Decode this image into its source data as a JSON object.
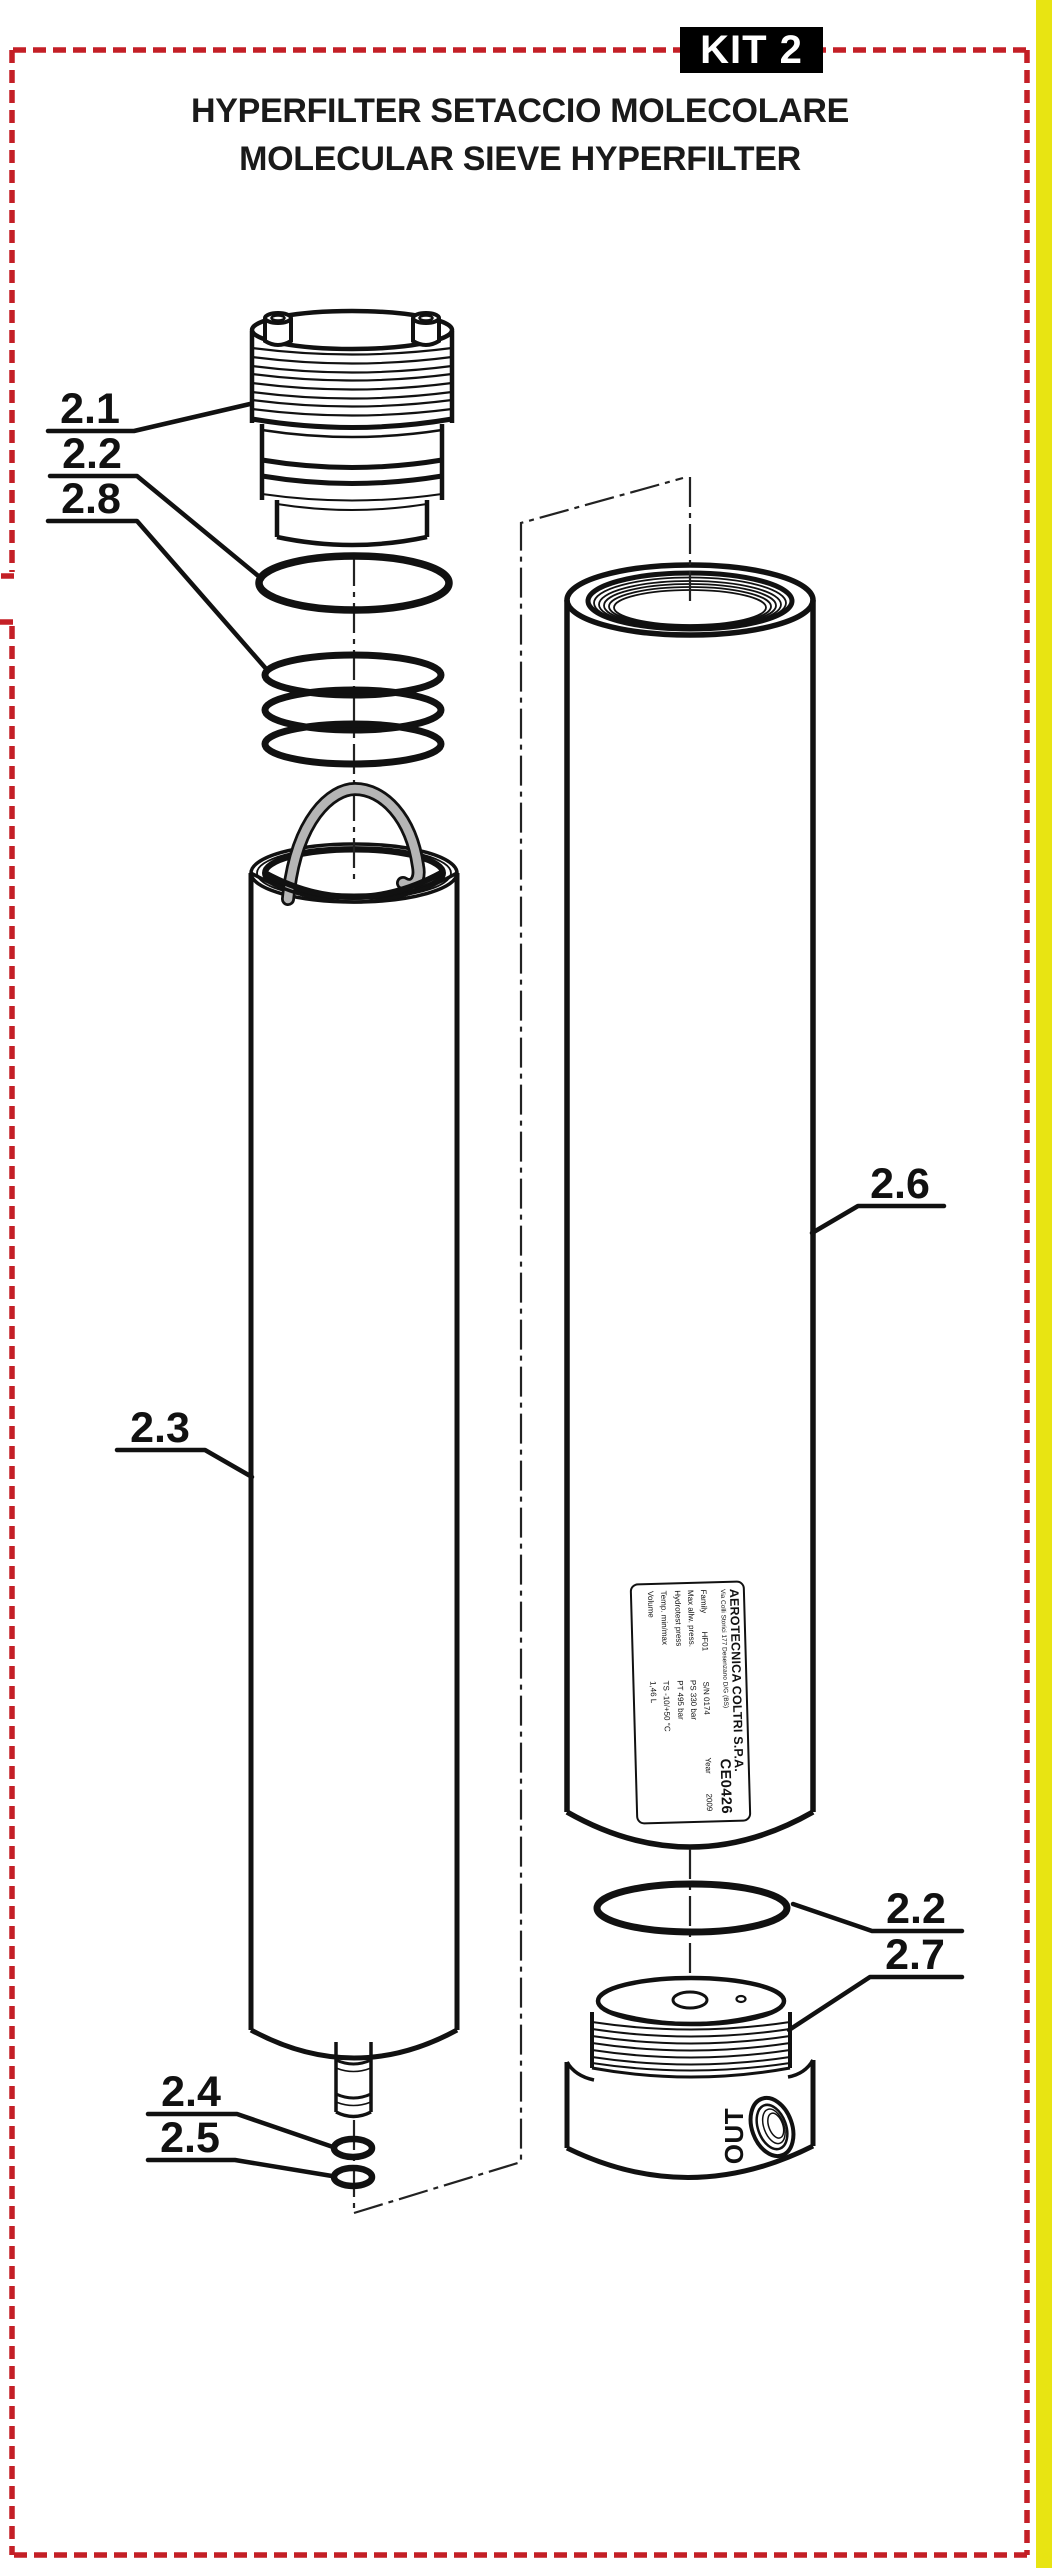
{
  "header": {
    "kit_badge": "KIT 2",
    "title_it": "HYPERFILTER SETACCIO MOLECOLARE",
    "title_en": "MOLECULAR SIEVE HYPERFILTER"
  },
  "callouts": {
    "cap": "2.1",
    "oring_top": "2.2",
    "spring": "2.8",
    "cartridge": "2.3",
    "housing": "2.6",
    "oring_bottom": "2.2",
    "end_cap": "2.7",
    "stem_oring_upper": "2.4",
    "stem_oring_lower": "2.5"
  },
  "port": {
    "label": "OUT"
  },
  "nameplate": {
    "company": "AEROTECNICA COLTRI S.P.A.",
    "address": "Via Colli Storici 177   Desenzano D/G (BS)",
    "ce_mark": "CE0426",
    "row1": {
      "label": "Family",
      "value": "HF01",
      "serial": "S/N 0174",
      "year_label": "Year",
      "year": "2009"
    },
    "rows": [
      {
        "label": "Max allw. press.",
        "value": "PS 330 bar"
      },
      {
        "label": "Hydrotest press",
        "value": "PT 495 bar"
      },
      {
        "label": "Temp. min/max",
        "value": "TS -10/+50 °C"
      },
      {
        "label": "Volume",
        "value": "1,46 L"
      }
    ]
  },
  "colors": {
    "border_red": "#c41f26",
    "side_strip_yellow": "#e8e412",
    "line_black": "#111111",
    "handle_gray": "#b5b5b5"
  }
}
